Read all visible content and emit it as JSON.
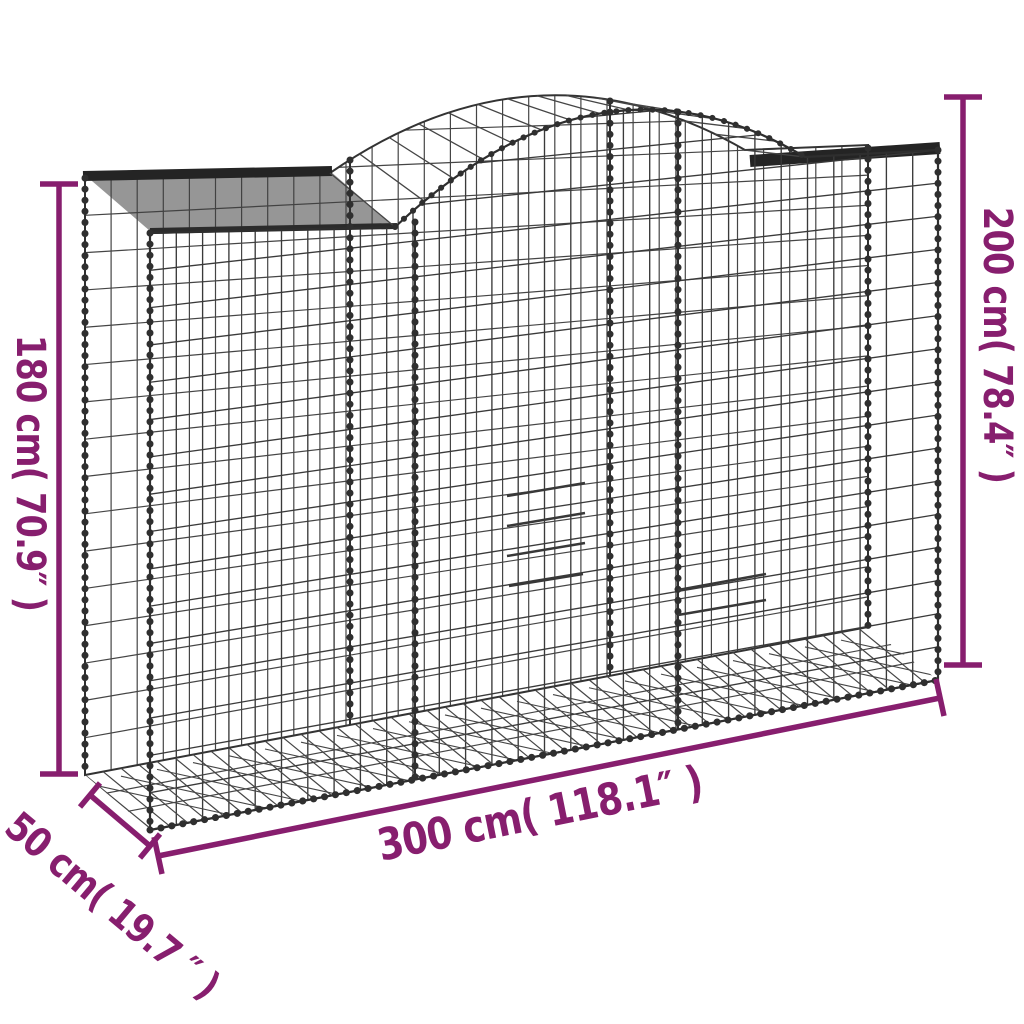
{
  "page": {
    "background": "#ffffff"
  },
  "illustration": {
    "subject": "arched-gabion-basket-wireframe",
    "mesh_color": "#454545",
    "rim_color": "#242424"
  },
  "annotations": {
    "accent_color": "#871E6E",
    "height_left": "180 cm( 70.9″ )",
    "height_right": "200 cm( 78.4″ )",
    "width_bottom": "300 cm( 118.1″ )",
    "depth": "50 cm( 19.7 ″ )"
  }
}
